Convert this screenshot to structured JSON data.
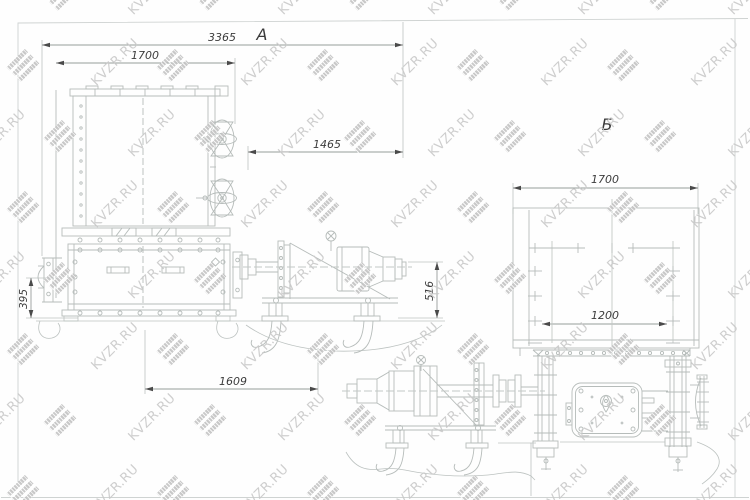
{
  "watermark": {
    "text": "KVZR.RU"
  },
  "views": {
    "a": {
      "label": "А",
      "dimensions": {
        "overall_length": "3365",
        "core_width": "1700",
        "drive_offset": "1465",
        "base_height": "395",
        "base_length": "1609",
        "drive_height": "516"
      }
    },
    "b": {
      "label": "Б",
      "dimensions": {
        "core_width": "1700",
        "opening_width": "1200"
      }
    }
  },
  "colors": {
    "line": "#b6bcba",
    "dim_line": "#979d9b",
    "arrow": "#4a4a4a",
    "text": "#3c3c3c",
    "watermark": "#c9c9c9"
  }
}
